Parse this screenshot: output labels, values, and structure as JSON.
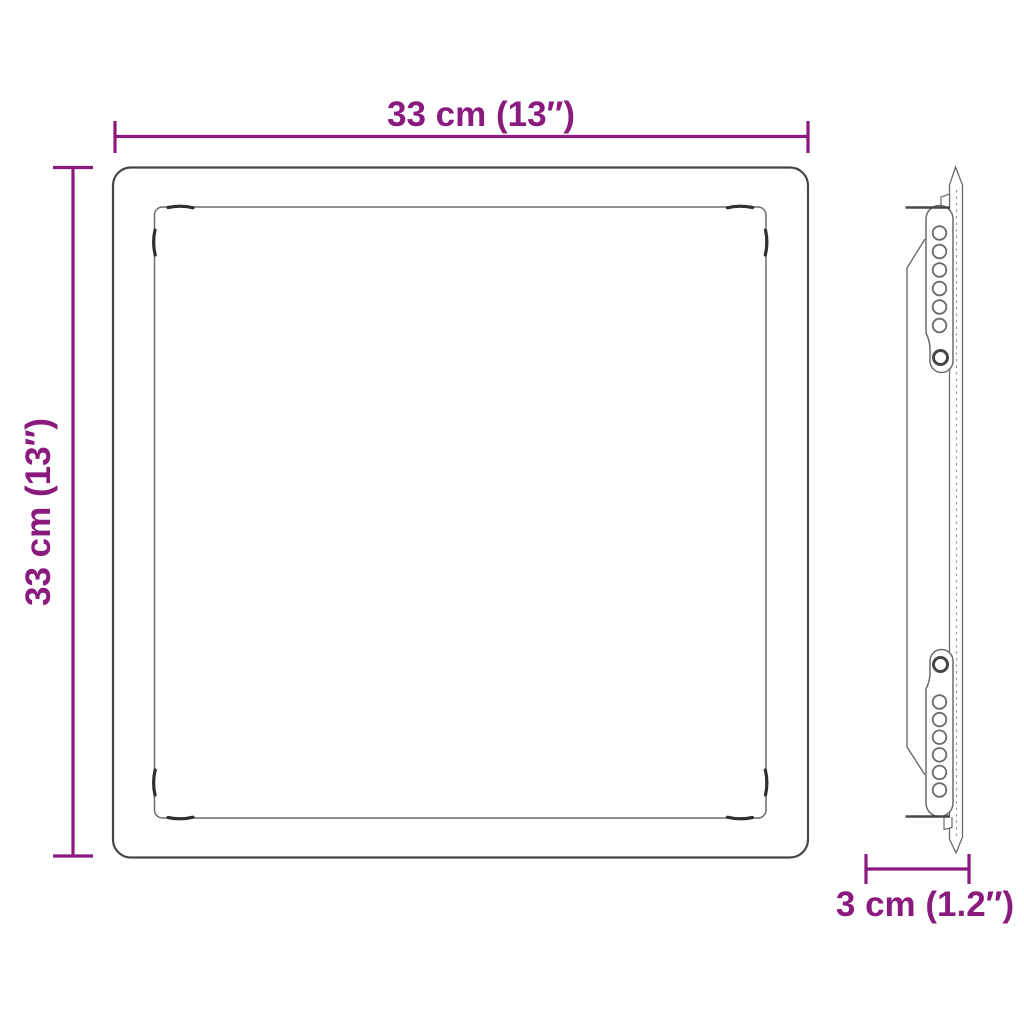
{
  "colors": {
    "background": "#ffffff",
    "dimension_accent": "#8A1A7E",
    "outline_dark": "#464646",
    "outline_mid": "#6b6b6b",
    "outline_light": "#9c9c9c",
    "clip_dark": "#2f2f2f"
  },
  "dimensions": {
    "width": {
      "label": "33 cm (13″)"
    },
    "height": {
      "label": "33 cm (13″)"
    },
    "depth": {
      "label": "3 cm (1.2″)"
    }
  },
  "side_view": {
    "bracket_count": 2,
    "holes_per_bracket": 7
  }
}
